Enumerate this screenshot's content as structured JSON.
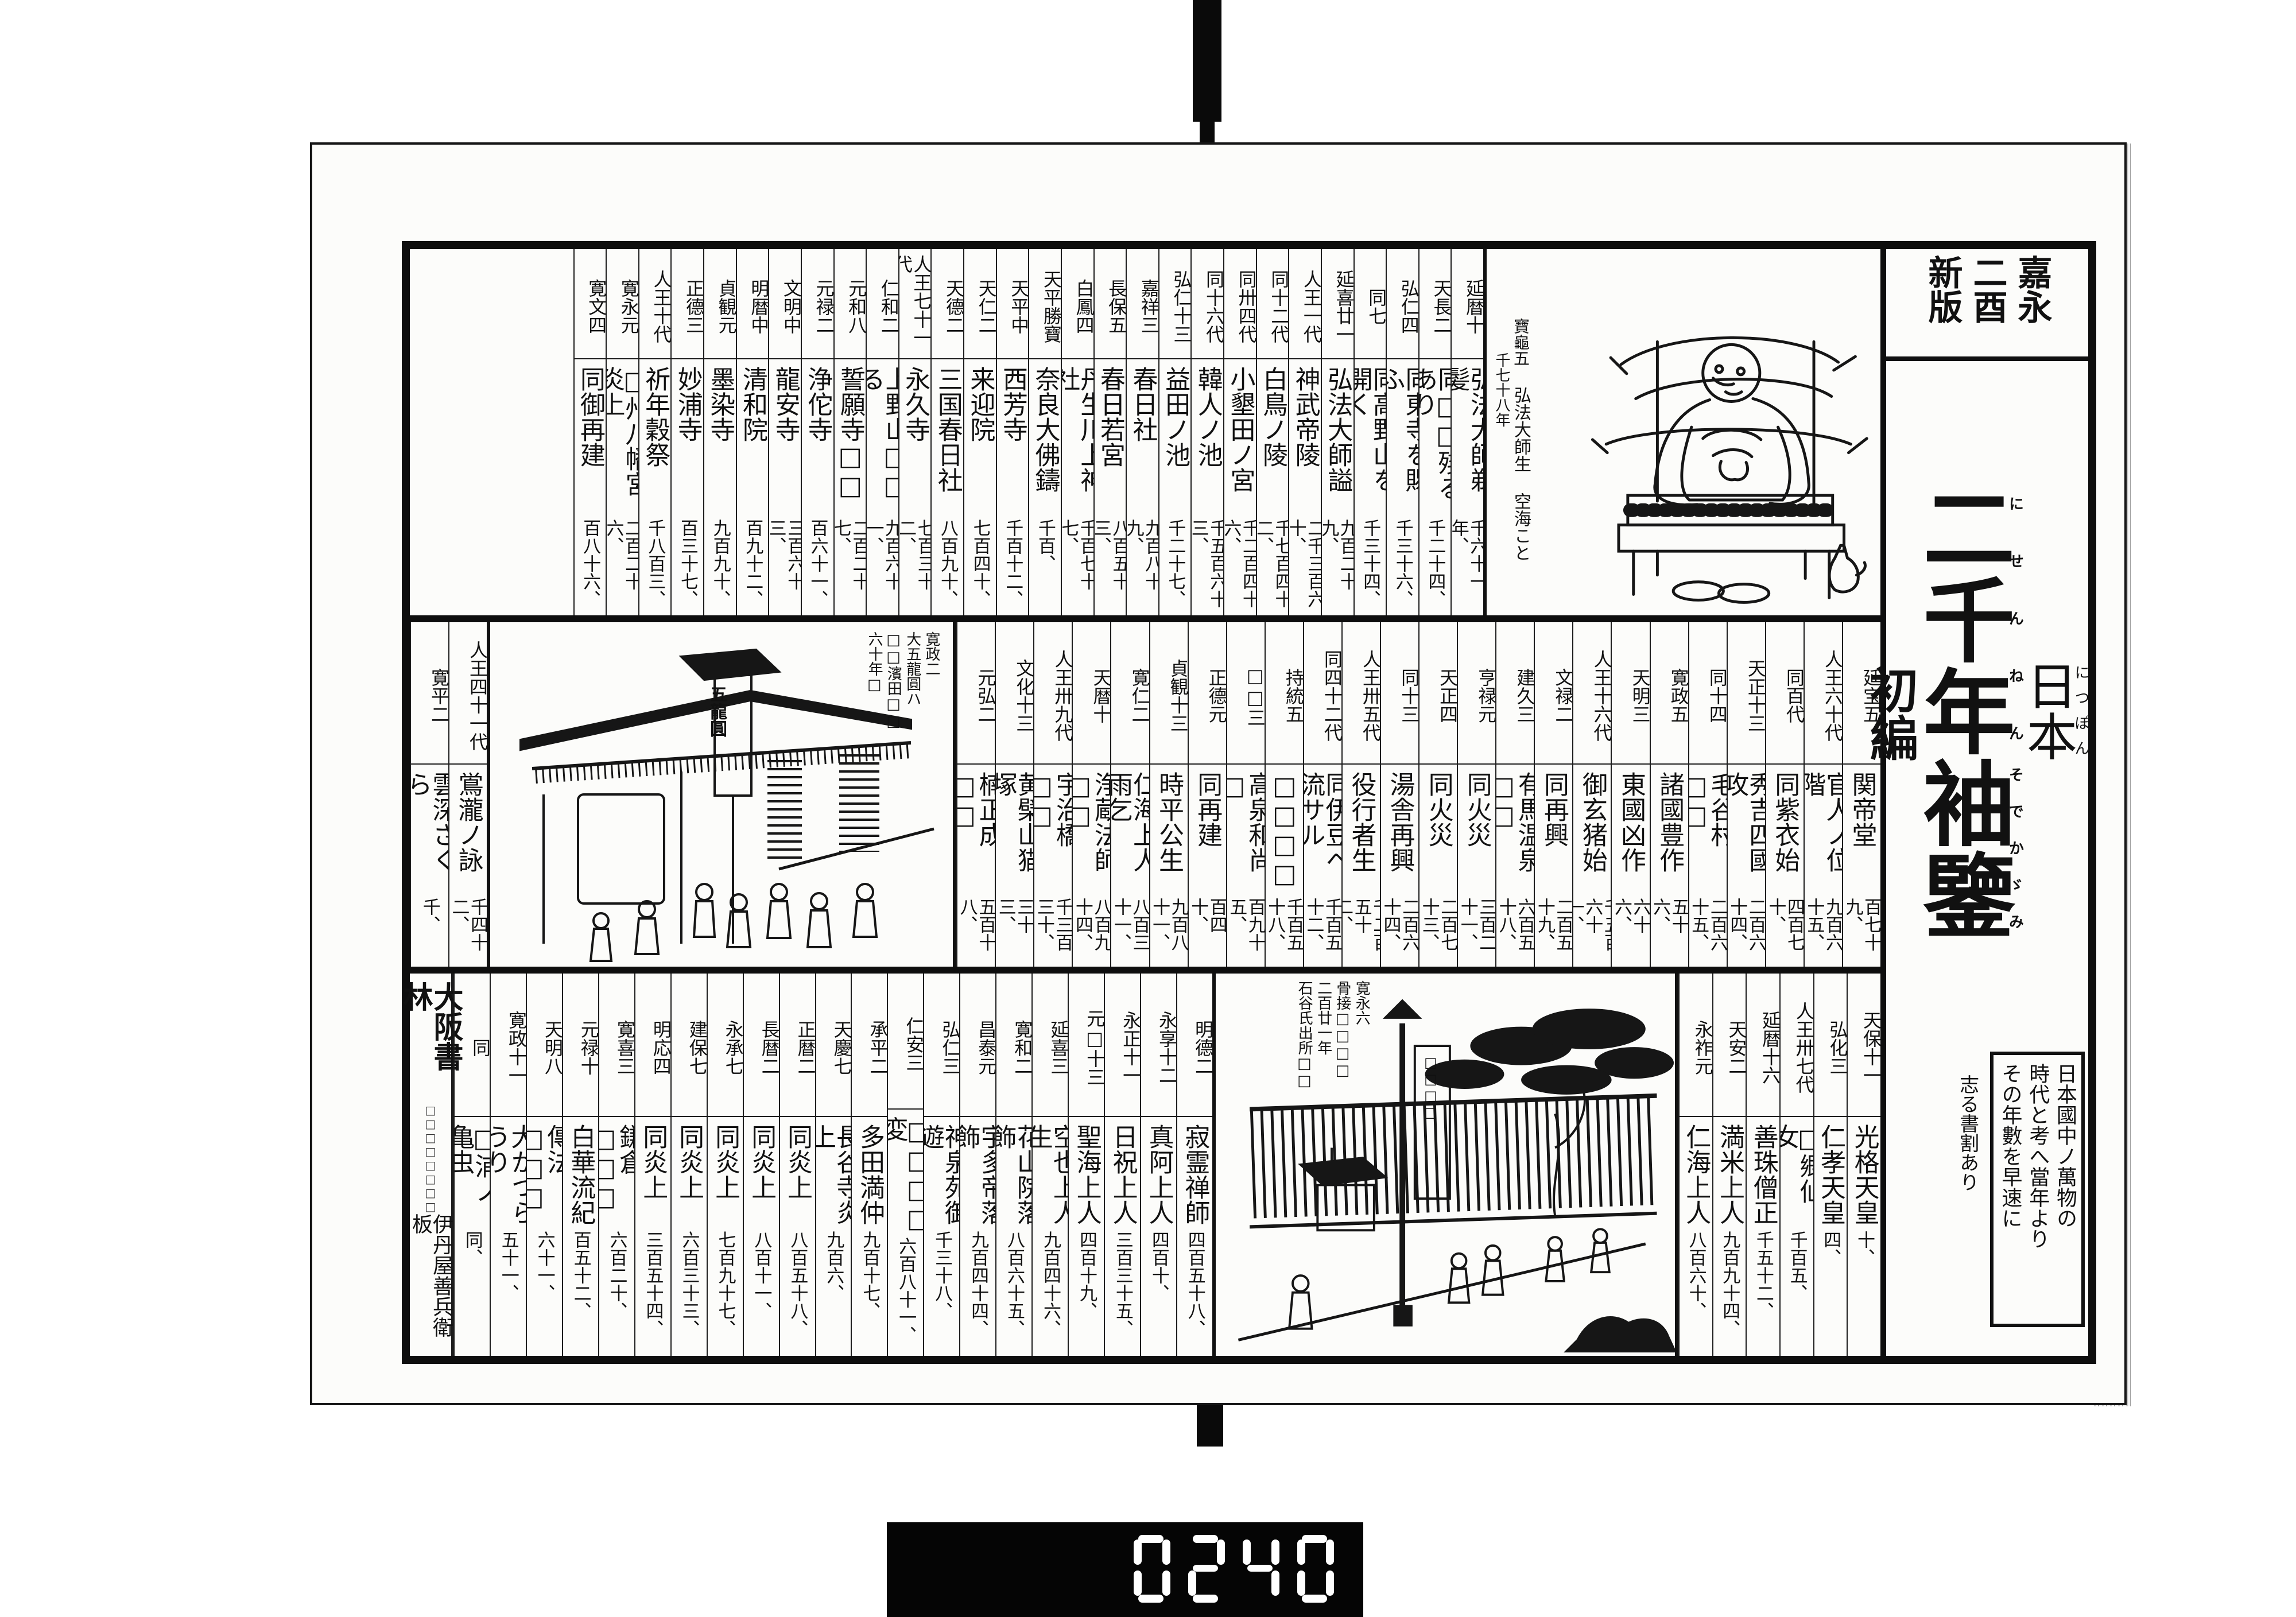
{
  "scan": {
    "counter_digits": "0240"
  },
  "strip": {
    "edition_box": [
      "嘉永",
      "二酉",
      "新版"
    ],
    "country": "日本",
    "country_rt": "につぽん",
    "title1": "二千年",
    "title1_rt": "にせんねん",
    "title2": "袖鑒",
    "title2_rt": "そでかゞみ",
    "edition": "初編",
    "note_lines": [
      "日本國中ノ萬物の",
      "時代と考へ當年より",
      "その年數を早速に"
    ],
    "note_side": "志る書割あり"
  },
  "figure": {
    "era": "寶龜五",
    "name": "弘法大師生",
    "alias": "空海こと",
    "years": "千七十八年"
  },
  "shop": {
    "captions": [
      "寛政二",
      "大五龍圓ハ",
      "□□濱田□□",
      "六十年□"
    ],
    "sign": "五龍圓"
  },
  "garden": {
    "captions": [
      "寛永六",
      "骨接□□□□",
      "二百廿一年",
      "石谷氏出所□□"
    ],
    "banner": "□□□□"
  },
  "colophon": {
    "publisher": "大阪書林",
    "small": "□□□□□□□□",
    "seller": "伊丹屋善兵衛板"
  },
  "bands": {
    "top": [
      {
        "era": "延暦十",
        "name": "弘法大師剃髪",
        "num": "千六十一年、"
      },
      {
        "era": "天長二",
        "name": "同□□殘るあり",
        "num": "千二十四、"
      },
      {
        "era": "弘仁四",
        "name": "同東寺を賜ふ",
        "num": "千三十六、"
      },
      {
        "era": "同七",
        "name": "同高野山を開く",
        "num": "千三十四、"
      },
      {
        "era": "延喜廿一",
        "name": "弘法大師謚",
        "num": "九百二十九、"
      },
      {
        "era": "人王一代",
        "name": "神武帝陵",
        "num": "二千三百六十、"
      },
      {
        "era": "同十二代",
        "name": "白鳥ノ陵",
        "num": "千七百四十二、"
      },
      {
        "era": "同卅四代",
        "name": "小墾田ノ宮",
        "num": "千二百四十六、"
      },
      {
        "era": "同十六代",
        "name": "韓人ノ池",
        "num": "千五百六十三、"
      },
      {
        "era": "弘仁十三",
        "name": "益田ノ池",
        "num": "千二十七、"
      },
      {
        "era": "嘉祥三",
        "name": "春日社",
        "num": "九百八十九、"
      },
      {
        "era": "長保五",
        "name": "春日若宮",
        "num": "八百五十三、"
      },
      {
        "era": "白鳳四",
        "name": "丹生川上神社",
        "num": "千百七十七、"
      },
      {
        "era": "天平勝寶",
        "name": "奈良大佛鑄",
        "num": "千百、"
      },
      {
        "era": "天平中",
        "name": "西芳寺",
        "num": "千百十二、"
      },
      {
        "era": "天仁二",
        "name": "来迎院",
        "num": "七百四十、"
      },
      {
        "era": "天德二",
        "name": "三国春日社",
        "num": "八百九十、"
      },
      {
        "era": "人王七十一代",
        "name": "永久寺",
        "num": "七百三十二、"
      },
      {
        "era": "仁和二",
        "name": "上野山□□る",
        "num": "九百六十一、"
      },
      {
        "era": "元和八",
        "name": "誓願寺□□",
        "num": "二百二十七、"
      },
      {
        "era": "元禄二",
        "name": "浄佗寺",
        "num": "百六十一、"
      },
      {
        "era": "文明中",
        "name": "龍安寺",
        "num": "三百六十三、"
      },
      {
        "era": "明暦中",
        "name": "清和院",
        "num": "百九十二、"
      },
      {
        "era": "貞観元",
        "name": "墨染寺",
        "num": "九百九十、"
      },
      {
        "era": "正德三",
        "name": "妙浦寺",
        "num": "百三十七、"
      },
      {
        "era": "人王十代",
        "name": "祈年穀祭",
        "num": "千八百三、"
      },
      {
        "era": "寛永元",
        "name": "□州八幡宮炎上",
        "num": "二百二十六、"
      },
      {
        "era": "寛文四",
        "name": "同御再建",
        "num": "百八十六、"
      }
    ],
    "middle": [
      {
        "era": "延宝五",
        "name": "関帝堂",
        "num": "百七十九、"
      },
      {
        "era": "人王六十代",
        "name": "官人ノ位階",
        "num": "九百六十五、"
      },
      {
        "era": "同百代",
        "name": "同紫衣始",
        "num": "四百七十、"
      },
      {
        "era": "天正十三",
        "name": "秀吉四國攻",
        "num": "二百六十四、"
      },
      {
        "era": "同十四",
        "name": "毛谷村□□",
        "num": "二百六十五、"
      },
      {
        "era": "寛政五",
        "name": "諸國豊作",
        "num": "五十六、"
      },
      {
        "era": "天明三",
        "name": "東國凶作",
        "num": "六十六、"
      },
      {
        "era": "人王十六代",
        "name": "御玄猪始",
        "num": "千五百六十一、"
      },
      {
        "era": "文禄二",
        "name": "同再興",
        "num": "二百五十九、"
      },
      {
        "era": "建久三",
        "name": "有馬温泉□□",
        "num": "六百五十八、"
      },
      {
        "era": "亨禄元",
        "name": "同火災",
        "num": "三百二十一、"
      },
      {
        "era": "天正四",
        "name": "同火災",
        "num": "二百七十三、"
      },
      {
        "era": "同十三",
        "name": "湯舎再興",
        "num": "二百六十四、"
      },
      {
        "era": "人王卅五代",
        "name": "役行者生",
        "num": "千二百五十二、"
      },
      {
        "era": "同四十二代",
        "name": "同伊豆ヘ流サル",
        "num": "千百五十二、"
      },
      {
        "era": "持統五",
        "name": "□□□□",
        "num": "千百五十八、"
      },
      {
        "era": "□□三",
        "name": "高泉和尚□",
        "num": "百九十五、"
      },
      {
        "era": "正德元",
        "name": "同再建",
        "num": "百四十、"
      },
      {
        "era": "貞観十三",
        "name": "時平公生",
        "num": "九百八十一、"
      },
      {
        "era": "寛仁二",
        "name": "仁海上人雨乞",
        "num": "八百三十一、"
      },
      {
        "era": "天暦十",
        "name": "浄蔵法師□□",
        "num": "八百九十四、"
      },
      {
        "era": "人王卅九代",
        "name": "宇治橋□□",
        "num": "千三百三十、"
      },
      {
        "era": "文化十三",
        "name": "黄檗山猫塚",
        "num": "三十三、"
      },
      {
        "era": "元弘二",
        "name": "楠正成□□",
        "num": "五百十八、"
      }
    ],
    "middle_left": [
      {
        "era": "人王四十一代",
        "name": "鴬瀧ノ詠",
        "num": "千四十二、"
      },
      {
        "era": "寛平二",
        "name": "雲深さくら",
        "num": "千、"
      }
    ],
    "bottom_right": [
      {
        "era": "天保十一",
        "name": "光格天皇",
        "num": "十、"
      },
      {
        "era": "弘化三",
        "name": "仁孝天皇",
        "num": "四、"
      },
      {
        "era": "人王卅七代",
        "name": "□郷仙女",
        "num": "千百五、"
      },
      {
        "era": "延暦十六",
        "name": "善珠僧正",
        "num": "千五十二、"
      },
      {
        "era": "天安二",
        "name": "満米上人",
        "num": "九百九十四、"
      },
      {
        "era": "永祚元",
        "name": "仁海上人",
        "num": "八百六十、"
      }
    ],
    "bottom_left": [
      {
        "era": "明德二",
        "name": "寂霊禅師",
        "num": "四百五十八、"
      },
      {
        "era": "永享十二",
        "name": "真阿上人",
        "num": "四百十、"
      },
      {
        "era": "永正十一",
        "name": "日祝上人",
        "num": "三百三十五、"
      },
      {
        "era": "元□十三",
        "name": "聖海上人",
        "num": "四百十九、"
      },
      {
        "era": "延喜三",
        "name": "空也上人生",
        "num": "九百四十六、"
      },
      {
        "era": "寛和二",
        "name": "花山院落飾",
        "num": "八百六十五、"
      },
      {
        "era": "昌泰元",
        "name": "宇多帝落飾",
        "num": "九百四十四、"
      },
      {
        "era": "弘仁三",
        "name": "神泉苑御遊",
        "num": "千三十八、"
      },
      {
        "era": "仁安三",
        "name": "□□□□変",
        "num": "六百八十一、"
      },
      {
        "era": "承平二",
        "name": "多田満仲",
        "num": "九百十七、"
      },
      {
        "era": "天慶七",
        "name": "長谷寺炎上",
        "num": "九百六、"
      },
      {
        "era": "正暦二",
        "name": "同炎上",
        "num": "八百五十八、"
      },
      {
        "era": "長暦二",
        "name": "同炎上",
        "num": "八百十一、"
      },
      {
        "era": "永承七",
        "name": "同炎上",
        "num": "七百九十七、"
      },
      {
        "era": "建保七",
        "name": "同炎上",
        "num": "六百三十三、"
      },
      {
        "era": "明応四",
        "name": "同炎上",
        "num": "三百五十四、"
      },
      {
        "era": "寛喜三",
        "name": "鎌倉□□□",
        "num": "六百二十、"
      },
      {
        "era": "元禄十",
        "name": "白華流紀",
        "num": "百五十二、"
      },
      {
        "era": "天明八",
        "name": "傳法□□□",
        "num": "六十一、"
      },
      {
        "era": "寛政十一",
        "name": "大かつらうり",
        "num": "五十一、"
      },
      {
        "era": "同",
        "name": "□浦ノ亀虫",
        "num": "同、"
      }
    ]
  }
}
